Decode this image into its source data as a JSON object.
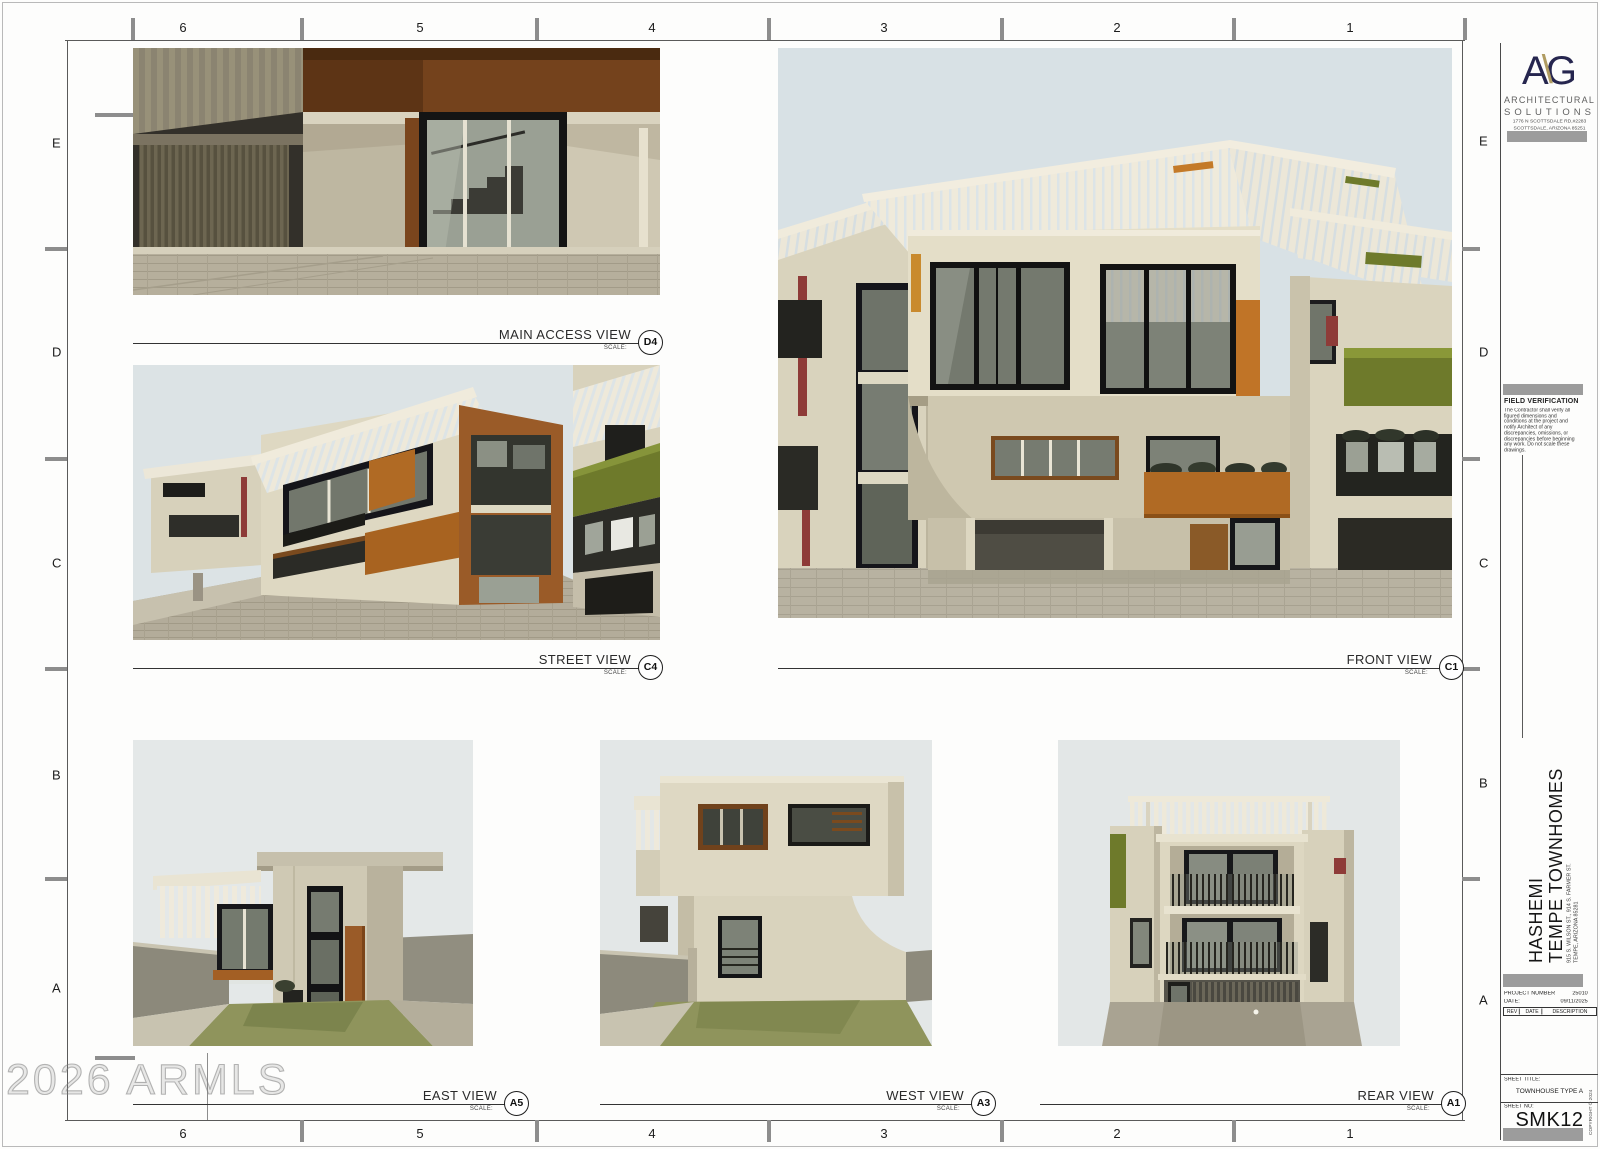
{
  "sheet": {
    "grid_cols": [
      "6",
      "5",
      "4",
      "3",
      "2",
      "1"
    ],
    "grid_rows": [
      "E",
      "D",
      "C",
      "B",
      "A"
    ],
    "watermark": "2026 ARMLS"
  },
  "title_block": {
    "logo": {
      "a": "A",
      "slash": "\\",
      "g": "G"
    },
    "firm_name_1": "ARCHITECTURAL",
    "firm_name_2": "SOLUTIONS",
    "address_1": "1776 N SCOTTSDALE RD,#2283",
    "address_2": "SCOTTSDALE, ARIZONA 85251",
    "phone": "480.670.3049",
    "field_verification_title": "FIELD VERIFICATION",
    "field_verification_body": "The Contractor shall verify all figured dimensions and conditions at the project and notify Architect of any discrepancies, omissions, or discrepancies before beginning any work. Do not scale these drawings.",
    "project_name_1": "HASHEMI",
    "project_name_2": "TEMPE TOWNHOMES",
    "project_address_1": "915 S. WILSON ST., 914 S. FARMER ST.",
    "project_address_2": "TEMPE, ARIZONA 85281",
    "project_number_label": "PROJECT NUMBER",
    "project_number": "25010",
    "date_label": "DATE:",
    "date": "09/11/2025",
    "rev_headers": [
      "REV",
      "DATE",
      "DESCRIPTION"
    ],
    "sheet_title_label": "SHEET TITLE:",
    "sheet_title": "TOWNHOUSE TYPE A",
    "sheet_no_label": "SHEET NO:",
    "sheet_no": "SMK12",
    "copyright": "COPYRIGHT © 2024"
  },
  "views": [
    {
      "name": "MAIN ACCESS VIEW",
      "ref": "D4",
      "scale_label": "SCALE:"
    },
    {
      "name": "STREET VIEW",
      "ref": "C4",
      "scale_label": "SCALE:"
    },
    {
      "name": "FRONT VIEW",
      "ref": "C1",
      "scale_label": "SCALE:"
    },
    {
      "name": "EAST VIEW",
      "ref": "A5",
      "scale_label": "SCALE:"
    },
    {
      "name": "WEST VIEW",
      "ref": "A3",
      "scale_label": "SCALE:"
    },
    {
      "name": "REAR VIEW",
      "ref": "A1",
      "scale_label": "SCALE:"
    }
  ],
  "palette": {
    "logo_navy": "#26264f",
    "logo_gold": "#b09c62",
    "bar_gray": "#9c9c9c",
    "accent_orange": "#b06a24",
    "accent_olive": "#6e7a2b",
    "accent_red": "#8e3b38",
    "sky": "#dce3e6",
    "wall_cream": "#ddd6c0",
    "frame_black": "#171717"
  }
}
